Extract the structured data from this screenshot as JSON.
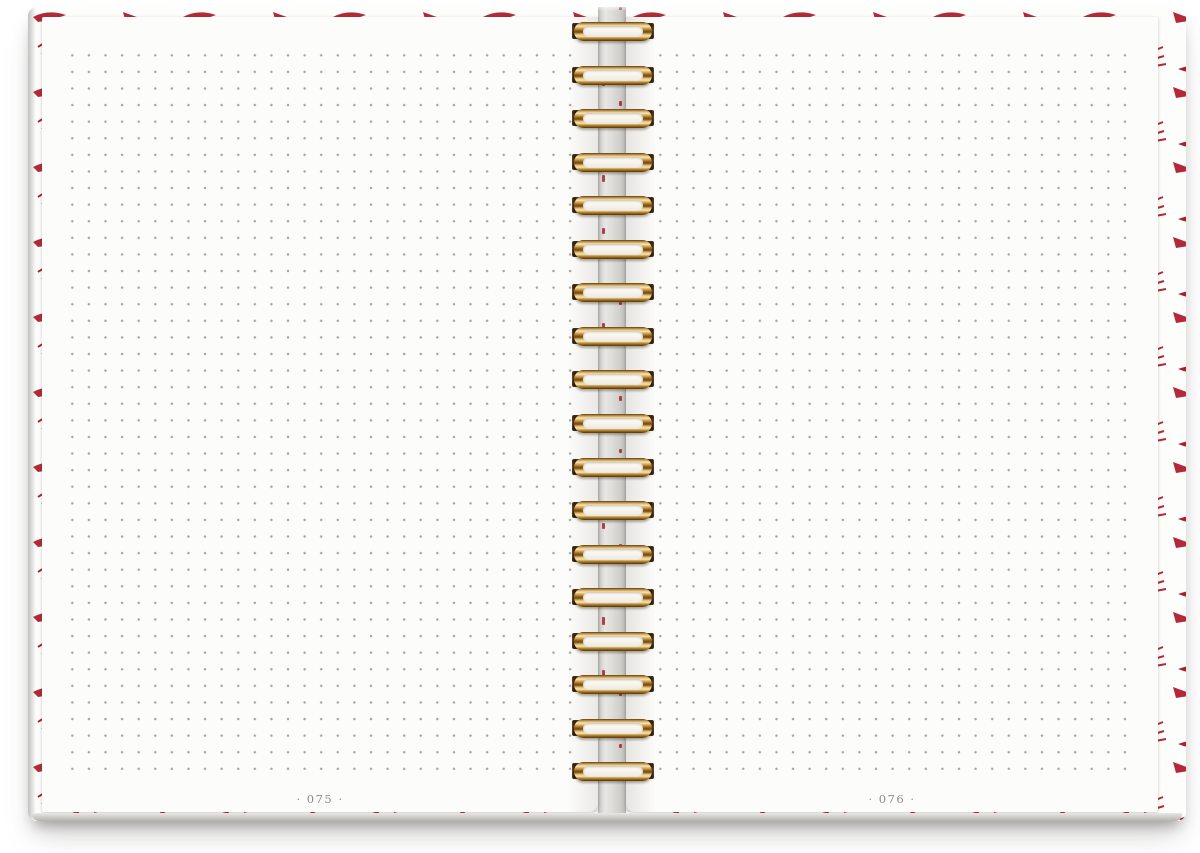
{
  "notebook": {
    "description": "Open spiral-bound notebook spread with blank dot-grid pages",
    "left_page": {
      "page_number": "· 075 ·"
    },
    "right_page": {
      "page_number": "· 076 ·"
    },
    "binding": {
      "coil_count": 18,
      "coil_spacing_px": 43.55,
      "coil_first_top_px": 15
    },
    "colors": {
      "cover_accent_red": "#b22a38",
      "coil_gold": "#c79b4e",
      "page_white": "#fcfcfa",
      "dot_gray": "#968c82",
      "spine_gray": "#d6d5d2",
      "page_number_gray": "#8f8d8a"
    }
  }
}
